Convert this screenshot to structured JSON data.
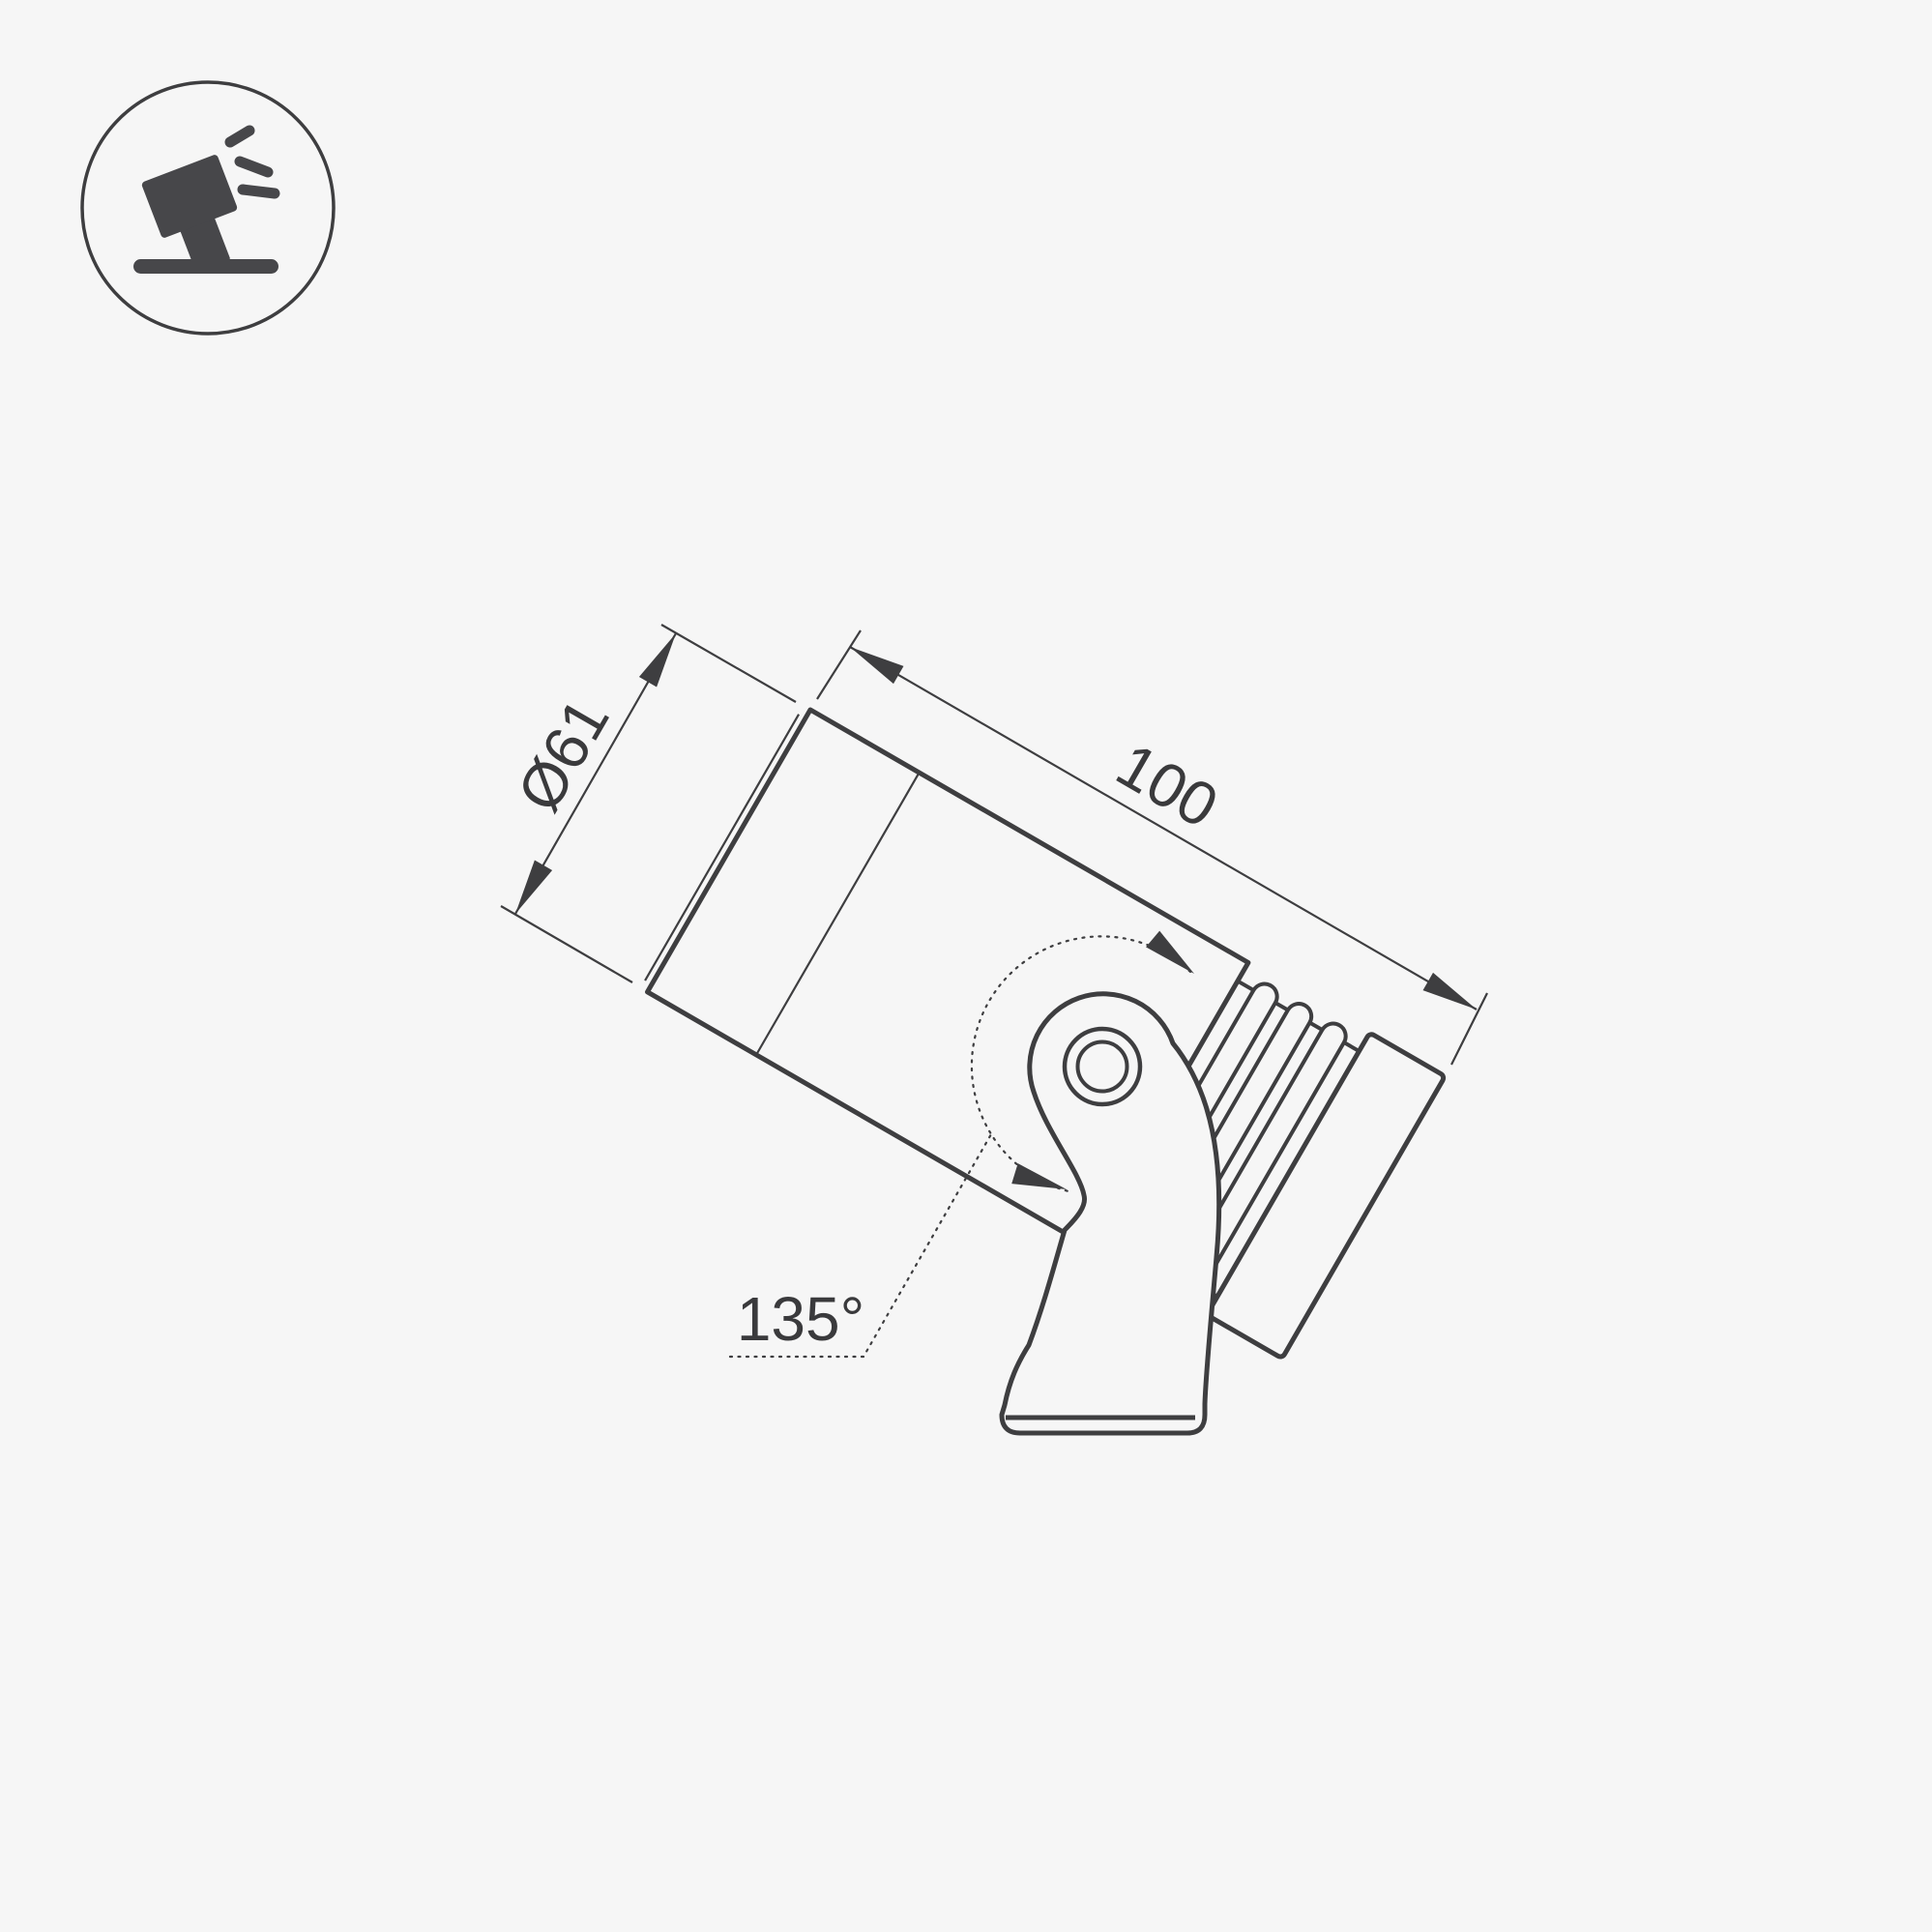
{
  "page": {
    "background_color": "#f6f6f6",
    "line_color": "#3e3e40",
    "icon_fill_color": "#47474a"
  },
  "icon": {
    "name": "tilted-spotlight-icon"
  },
  "drawing": {
    "type": "product-dimension-diagram",
    "subject": "adjustable LED spot luminaire on mounting bracket, side view",
    "dimensions": {
      "diameter_label": "Ø61",
      "length_label": "100",
      "rotation_angle_label": "135°"
    }
  }
}
